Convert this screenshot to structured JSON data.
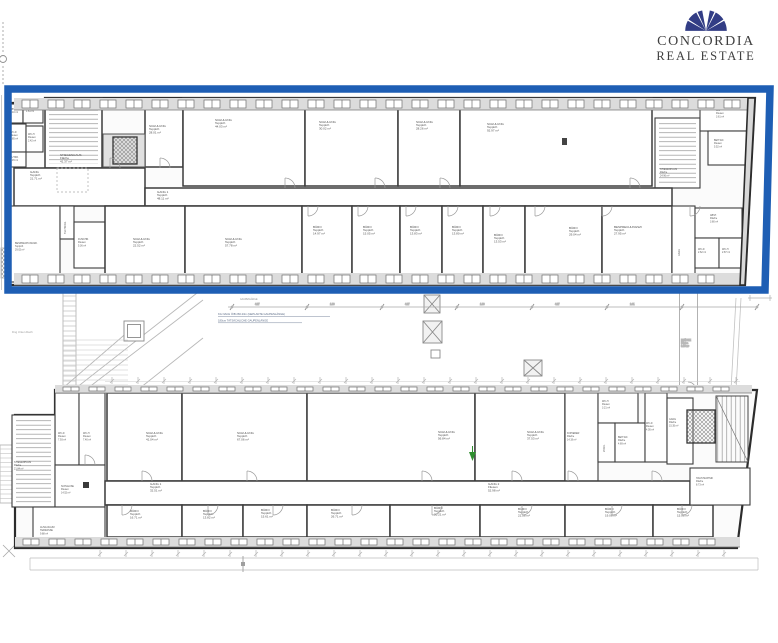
{
  "brand": {
    "line1": "CONCORDIA",
    "line2": "REAL ESTATE",
    "fan_color": "#323d85",
    "text_color": "#3f3f3f"
  },
  "highlight": {
    "color": "#1e5eb4"
  },
  "courtyard": {
    "dim_title": "GAUPENLÄNGE",
    "dim_values": [
      "4.27",
      "1.80",
      "4.27",
      "1.80",
      "4.27",
      "2.41"
    ],
    "note_line1": "KG NACH ÖIB 266.23m  (GEPLANTE GAUPENLÄNGE)",
    "note_line2": "180cm  TATSÄCHLICHE GAUPENLÄNGE",
    "left_label": "Dng Unten Dach",
    "bridge": {
      "name": "BRÜCKE",
      "sub": "Fläche",
      "area": "9.60 m²"
    }
  },
  "upper_wing": {
    "rooms": [
      {
        "n": "ABST.",
        "a": "1.10 m²",
        "x": 8,
        "y": 104,
        "w": 15,
        "h": 19,
        "sm": 1,
        "lx": 10,
        "ly": 110
      },
      {
        "n": "VORR.",
        "a": "1.61 m²",
        "x": 23,
        "y": 103,
        "w": 20,
        "h": 20,
        "sm": 1,
        "lx": 26,
        "ly": 109
      },
      {
        "n": "WC-D",
        "s": "Fliesen",
        "a": "2.85 m²",
        "x": 8,
        "y": 124,
        "w": 18,
        "h": 28,
        "sm": 1,
        "lx": 10,
        "ly": 133
      },
      {
        "n": "WC-H",
        "s": "Fliesen",
        "a": "2.42 m²",
        "x": 26,
        "y": 126,
        "w": 17,
        "h": 26,
        "sm": 1,
        "lx": 28,
        "ly": 135
      },
      {
        "n": "PUTZR.",
        "a": "1.45 m²",
        "x": 8,
        "y": 152,
        "w": 18,
        "h": 15,
        "sm": 1,
        "lx": 10,
        "ly": 158
      },
      {
        "n": "STIEGENHAUS",
        "s": "Fläche",
        "a": "41.37 m²",
        "x": 45,
        "y": 98,
        "w": 57,
        "h": 70,
        "pat": "stH",
        "lx": 60,
        "ly": 156
      },
      {
        "n": "SCHULUNG",
        "s": "Teppich",
        "a": "28.01 m²",
        "x": 145,
        "y": 103,
        "w": 38,
        "h": 64,
        "lx": 149,
        "ly": 127
      },
      {
        "n": "SCHULUNG",
        "s": "Teppich",
        "a": "44.03 m²",
        "x": 183,
        "y": 98,
        "w": 122,
        "h": 88,
        "lx": 215,
        "ly": 121
      },
      {
        "n": "SCHULUNG",
        "s": "Teppich",
        "a": "30.02 m²",
        "x": 305,
        "y": 98,
        "w": 93,
        "h": 88,
        "lx": 319,
        "ly": 123
      },
      {
        "n": "SCHULUNG",
        "s": "Teppich",
        "a": "28.26 m²",
        "x": 398,
        "y": 98,
        "w": 62,
        "h": 88,
        "lx": 416,
        "ly": 123
      },
      {
        "n": "SCHULUNG",
        "s": "Teppich",
        "a": "92.97 m²",
        "x": 460,
        "y": 98,
        "w": 192,
        "h": 88,
        "lx": 487,
        "ly": 125
      },
      {
        "n": "STIEGENHAUS",
        "s": "Fläche",
        "a": "24.96 m²",
        "x": 655,
        "y": 118,
        "w": 45,
        "h": 70,
        "pat": "stH",
        "sm": 1,
        "lx": 660,
        "ly": 170
      },
      {
        "n": "WC",
        "s": "Fliesen",
        "a": "3.61 m²",
        "x": 700,
        "y": 105,
        "w": 48,
        "h": 26,
        "sm": 1,
        "lx": 716,
        "ly": 111
      },
      {
        "n": "BEH.WC",
        "s": "Fliesen",
        "a": "5.52 m²",
        "x": 708,
        "y": 131,
        "w": 41,
        "h": 34,
        "sm": 1,
        "lx": 714,
        "ly": 141
      },
      {
        "n": "GANG",
        "s": "Teppich",
        "a": "21.71 m²",
        "x": 14,
        "y": 168,
        "w": 131,
        "h": 38,
        "lx": 30,
        "ly": 173
      },
      {
        "n": "GANG 1",
        "s": "Teppich",
        "a": "48.11 m²",
        "x": 145,
        "y": 188,
        "w": 527,
        "h": 18,
        "lx": 157,
        "ly": 193
      },
      {
        "n": "BESPRECHUNGSR.",
        "s": "Teppich",
        "a": "29.02 m²",
        "x": 10,
        "y": 206,
        "w": 50,
        "h": 76,
        "sm": 1,
        "lx": 15,
        "ly": 244
      },
      {
        "n": "TECHNIKR.",
        "a": "2.91 m²",
        "x": 60,
        "y": 206,
        "w": 14,
        "h": 33,
        "rot": 1,
        "sm": 1,
        "lx": 66,
        "ly": 234
      },
      {
        "n": "DUSCHR.",
        "s": "Fliesen",
        "a": "5.36 m²",
        "x": 74,
        "y": 222,
        "w": 31,
        "h": 46,
        "sm": 1,
        "lx": 78,
        "ly": 240
      },
      {
        "n": "SCHULUNG",
        "s": "Teppich",
        "a": "22.52 m²",
        "x": 105,
        "y": 206,
        "w": 80,
        "h": 76,
        "lx": 133,
        "ly": 240
      },
      {
        "n": "SCHULUNG",
        "s": "Teppich",
        "a": "57.78 m²",
        "x": 185,
        "y": 206,
        "w": 117,
        "h": 76,
        "lx": 225,
        "ly": 240
      },
      {
        "n": "BÜRO",
        "s": "Teppich",
        "a": "14.97 m²",
        "x": 302,
        "y": 206,
        "w": 50,
        "h": 76,
        "lx": 313,
        "ly": 228
      },
      {
        "n": "BÜRO",
        "s": "Teppich",
        "a": "15.05 m²",
        "x": 352,
        "y": 206,
        "w": 48,
        "h": 76,
        "lx": 363,
        "ly": 228
      },
      {
        "n": "BÜRO",
        "s": "Teppich",
        "a": "13.83 m²",
        "x": 400,
        "y": 206,
        "w": 42,
        "h": 76,
        "lx": 410,
        "ly": 228
      },
      {
        "n": "BÜRO",
        "s": "Teppich",
        "a": "13.80 m²",
        "x": 442,
        "y": 206,
        "w": 41,
        "h": 76,
        "lx": 452,
        "ly": 228
      },
      {
        "n": "BÜRO",
        "s": "Teppich",
        "a": "13.53 m²",
        "x": 483,
        "y": 206,
        "w": 42,
        "h": 76,
        "lx": 494,
        "ly": 236
      },
      {
        "n": "BÜRO",
        "s": "Teppich",
        "a": "29.04 m²",
        "x": 525,
        "y": 206,
        "w": 77,
        "h": 76,
        "lx": 569,
        "ly": 229
      },
      {
        "n": "BESPRECHUNGSZI",
        "s": "Teppich",
        "a": "27.95 m²",
        "x": 602,
        "y": 206,
        "w": 70,
        "h": 76,
        "lx": 614,
        "ly": 228
      },
      {
        "n": "GANG",
        "a": "6.92 m²",
        "x": 672,
        "y": 206,
        "w": 23,
        "h": 79,
        "rot": 1,
        "sm": 1,
        "lx": 680,
        "ly": 256
      },
      {
        "n": "ABST.",
        "s": "Fläche",
        "a": "3.80 m²",
        "x": 695,
        "y": 208,
        "w": 47,
        "h": 30,
        "sm": 1,
        "lx": 710,
        "ly": 216
      },
      {
        "n": "WC-D",
        "a": "2.62 m²",
        "x": 695,
        "y": 238,
        "w": 24,
        "h": 30,
        "sm": 1,
        "lx": 698,
        "ly": 250
      },
      {
        "n": "WC-H",
        "a": "2.87 m²",
        "x": 719,
        "y": 238,
        "w": 24,
        "h": 30,
        "sm": 1,
        "lx": 722,
        "ly": 250
      }
    ]
  },
  "lower_wing": {
    "rooms": [
      {
        "n": "WC-D",
        "s": "Fliesen",
        "a": "7.93 m²",
        "x": 55,
        "y": 393,
        "w": 24,
        "h": 72,
        "sm": 1,
        "lx": 58,
        "ly": 434
      },
      {
        "n": "WC-H",
        "s": "Fliesen",
        "a": "7.40 m²",
        "x": 79,
        "y": 393,
        "w": 26,
        "h": 72,
        "sm": 1,
        "lx": 83,
        "ly": 434
      },
      {
        "n": "SCHULUNG",
        "s": "Teppich",
        "a": "41.04 m²",
        "x": 107,
        "y": 393,
        "w": 75,
        "h": 88,
        "lx": 146,
        "ly": 434
      },
      {
        "n": "SCHULUNG",
        "s": "Teppich",
        "a": "67.06 m²",
        "x": 182,
        "y": 393,
        "w": 125,
        "h": 88,
        "lx": 237,
        "ly": 434
      },
      {
        "n": "SCHULUNG",
        "s": "Teppich",
        "a": "56.84 m²",
        "x": 307,
        "y": 393,
        "w": 168,
        "h": 88,
        "lx": 438,
        "ly": 433
      },
      {
        "n": "SCHULUNG",
        "s": "Teppich",
        "a": "37.53 m²",
        "x": 475,
        "y": 393,
        "w": 90,
        "h": 88,
        "lx": 527,
        "ly": 433
      },
      {
        "n": "KOPIERER",
        "s": "Fläche",
        "a": "14.19 m²",
        "x": 565,
        "y": 393,
        "w": 33,
        "h": 88,
        "sm": 1,
        "lx": 567,
        "ly": 434
      },
      {
        "n": "WC-H",
        "s": "Fliesen",
        "a": "3.21 m²",
        "x": 598,
        "y": 393,
        "w": 40,
        "h": 30,
        "sm": 1,
        "lx": 602,
        "ly": 402
      },
      {
        "n": "VORR.",
        "a": "2.12 m²",
        "x": 598,
        "y": 423,
        "w": 17,
        "h": 39,
        "sm": 1,
        "rot": 1,
        "lx": 605,
        "ly": 452
      },
      {
        "n": "BEH.WC",
        "s": "Fläche",
        "a": "4.69 m²",
        "x": 615,
        "y": 423,
        "w": 30,
        "h": 39,
        "sm": 1,
        "lx": 618,
        "ly": 438
      },
      {
        "n": "WC-D",
        "s": "Fliesen",
        "a": "4.05 m²",
        "x": 645,
        "y": 393,
        "w": 22,
        "h": 69,
        "sm": 1,
        "lx": 646,
        "ly": 424
      },
      {
        "n": "GANG",
        "s": "Fläche",
        "a": "15.35 m²",
        "x": 667,
        "y": 398,
        "w": 26,
        "h": 66,
        "sm": 1,
        "lx": 669,
        "ly": 420
      },
      {
        "n": "STIEGENHAUS",
        "s": "Fläche",
        "a": "21.84 m²",
        "x": 12,
        "y": 415,
        "w": 43,
        "h": 92,
        "pat": "stH",
        "sm": 1,
        "lx": 14,
        "ly": 463
      },
      {
        "n": "SCHLEUSE",
        "s": "Fliesen",
        "a": "14.52 m²",
        "x": 55,
        "y": 465,
        "w": 50,
        "h": 42,
        "sm": 1,
        "lx": 61,
        "ly": 487
      },
      {
        "n": "AUSG.RAUM",
        "s": "TERRASSE",
        "a": "9.88 m²",
        "x": 33,
        "y": 507,
        "w": 72,
        "h": 36,
        "sm": 1,
        "lx": 40,
        "ly": 528
      },
      {
        "n": "GANG 1",
        "s": "Teppich",
        "a": "32.51 m²",
        "x": 105,
        "y": 481,
        "w": 585,
        "h": 24,
        "lx": 150,
        "ly": 485
      },
      {
        "n": "GANG 2",
        "s": "Fliesen",
        "a": "52.98 m²",
        "nr": 1,
        "lx": 488,
        "ly": 485
      },
      {
        "n": "BÜRO",
        "s": "Teppich",
        "a": "16.71 m²",
        "x": 107,
        "y": 505,
        "w": 75,
        "h": 32,
        "lx": 130,
        "ly": 512
      },
      {
        "n": "BÜRO",
        "s": "Teppich",
        "a": "13.82 m²",
        "x": 182,
        "y": 505,
        "w": 61,
        "h": 32,
        "lx": 203,
        "ly": 512
      },
      {
        "n": "BÜRO",
        "s": "Teppich",
        "a": "15.61 m²",
        "x": 243,
        "y": 505,
        "w": 64,
        "h": 32,
        "lx": 261,
        "ly": 511
      },
      {
        "n": "BÜRO",
        "s": "Teppich",
        "a": "26.71 m²",
        "x": 307,
        "y": 505,
        "w": 83,
        "h": 32,
        "lx": 331,
        "ly": 511
      },
      {
        "n": "BÜRO",
        "s": "Teppich",
        "a": "20.21 m²",
        "x": 390,
        "y": 505,
        "w": 90,
        "h": 32,
        "lx": 434,
        "ly": 509
      },
      {
        "n": "BÜRO",
        "s": "Teppich",
        "a": "21.58 m²",
        "x": 480,
        "y": 505,
        "w": 85,
        "h": 32,
        "lx": 518,
        "ly": 510
      },
      {
        "n": "BÜRO",
        "s": "Teppich",
        "a": "19.08 m²",
        "x": 565,
        "y": 505,
        "w": 88,
        "h": 32,
        "lx": 605,
        "ly": 510
      },
      {
        "n": "BÜRO",
        "s": "Teppich",
        "a": "15.08 m²",
        "x": 653,
        "y": 505,
        "w": 60,
        "h": 32,
        "lx": 677,
        "ly": 510
      },
      {
        "n": "HAUSTECHNIK",
        "s": "Fläche",
        "a": "8.73 m²",
        "x": 690,
        "y": 468,
        "w": 60,
        "h": 37,
        "sm": 1,
        "lx": 696,
        "ly": 479
      }
    ]
  }
}
